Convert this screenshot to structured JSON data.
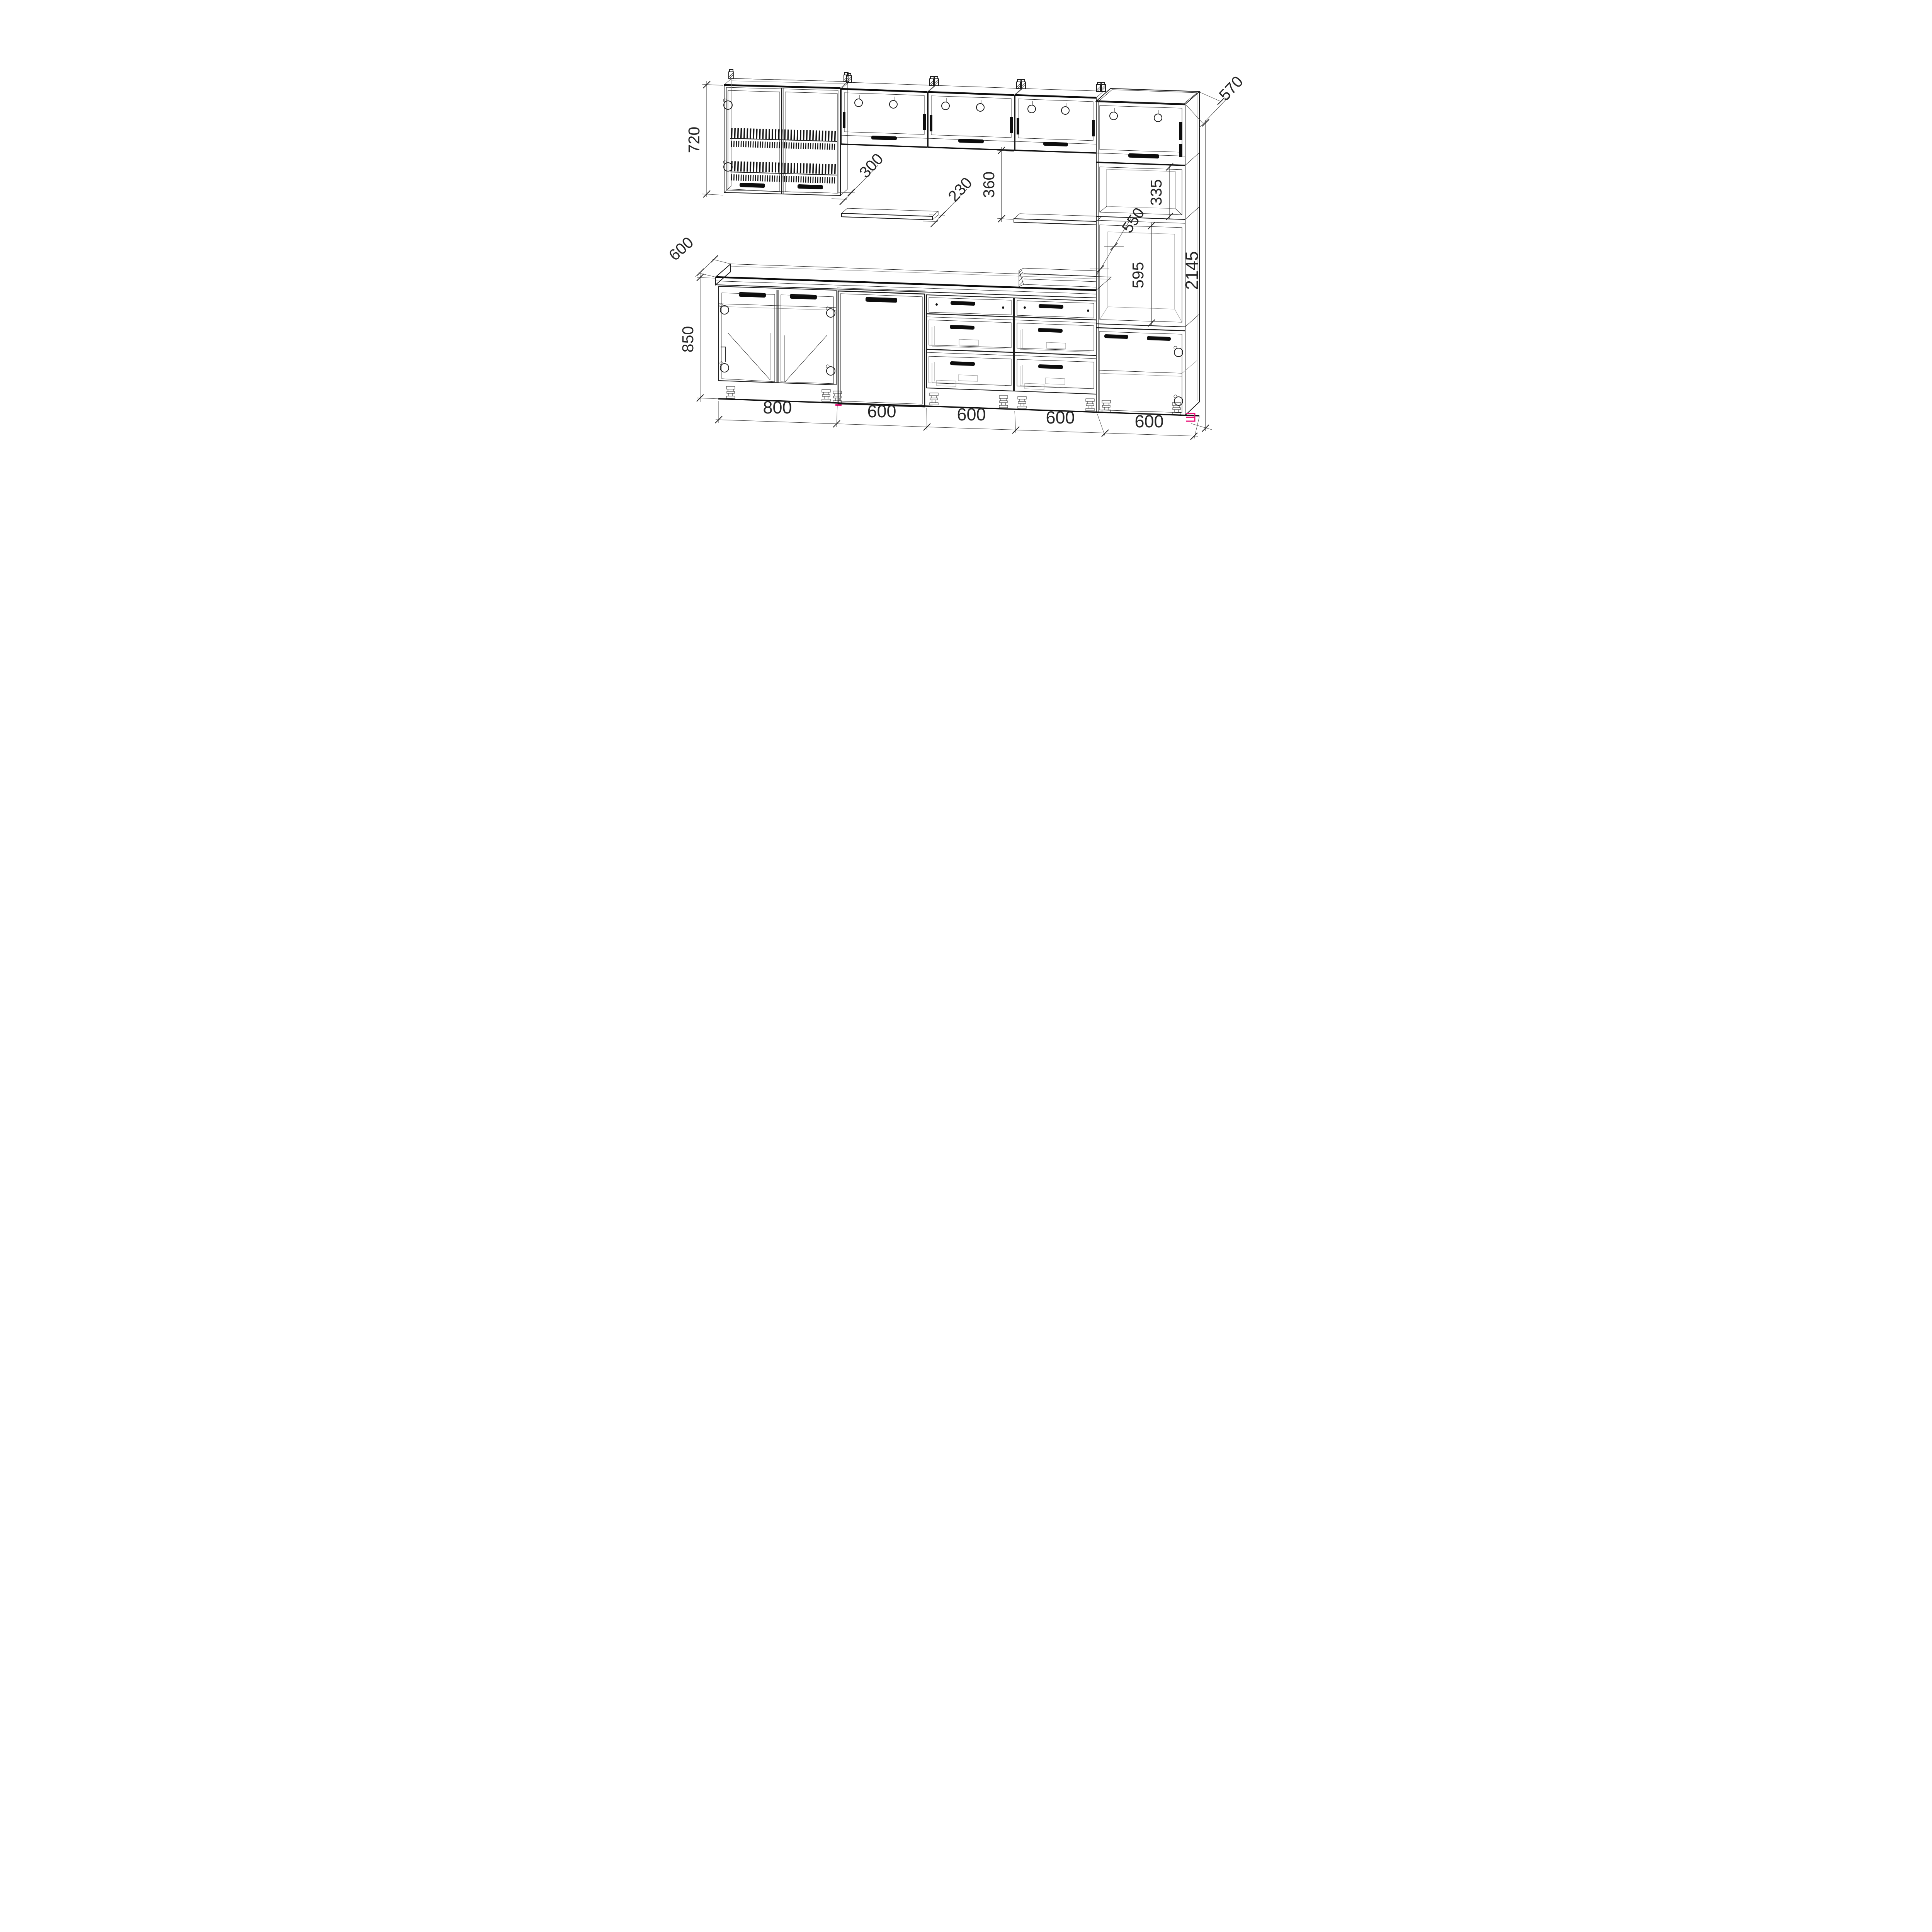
{
  "drawing": {
    "background": "#ffffff",
    "line_color": "#1c1c1c",
    "accent_color": "#ea1178",
    "dims": {
      "wall_cabinet_height": "720",
      "wall_cabinet_depth": "300",
      "wall_shelf_depth": "230",
      "flip_cabinet_gap": "360",
      "tall_top_depth": "570",
      "tall_upper_niche_height": "335",
      "tall_niche_depth": "550",
      "oven_niche_height": "595",
      "total_height": "2145",
      "worktop_depth": "600",
      "base_cabinet_height": "850",
      "widths": [
        "800",
        "600",
        "600",
        "600",
        "600"
      ]
    }
  }
}
